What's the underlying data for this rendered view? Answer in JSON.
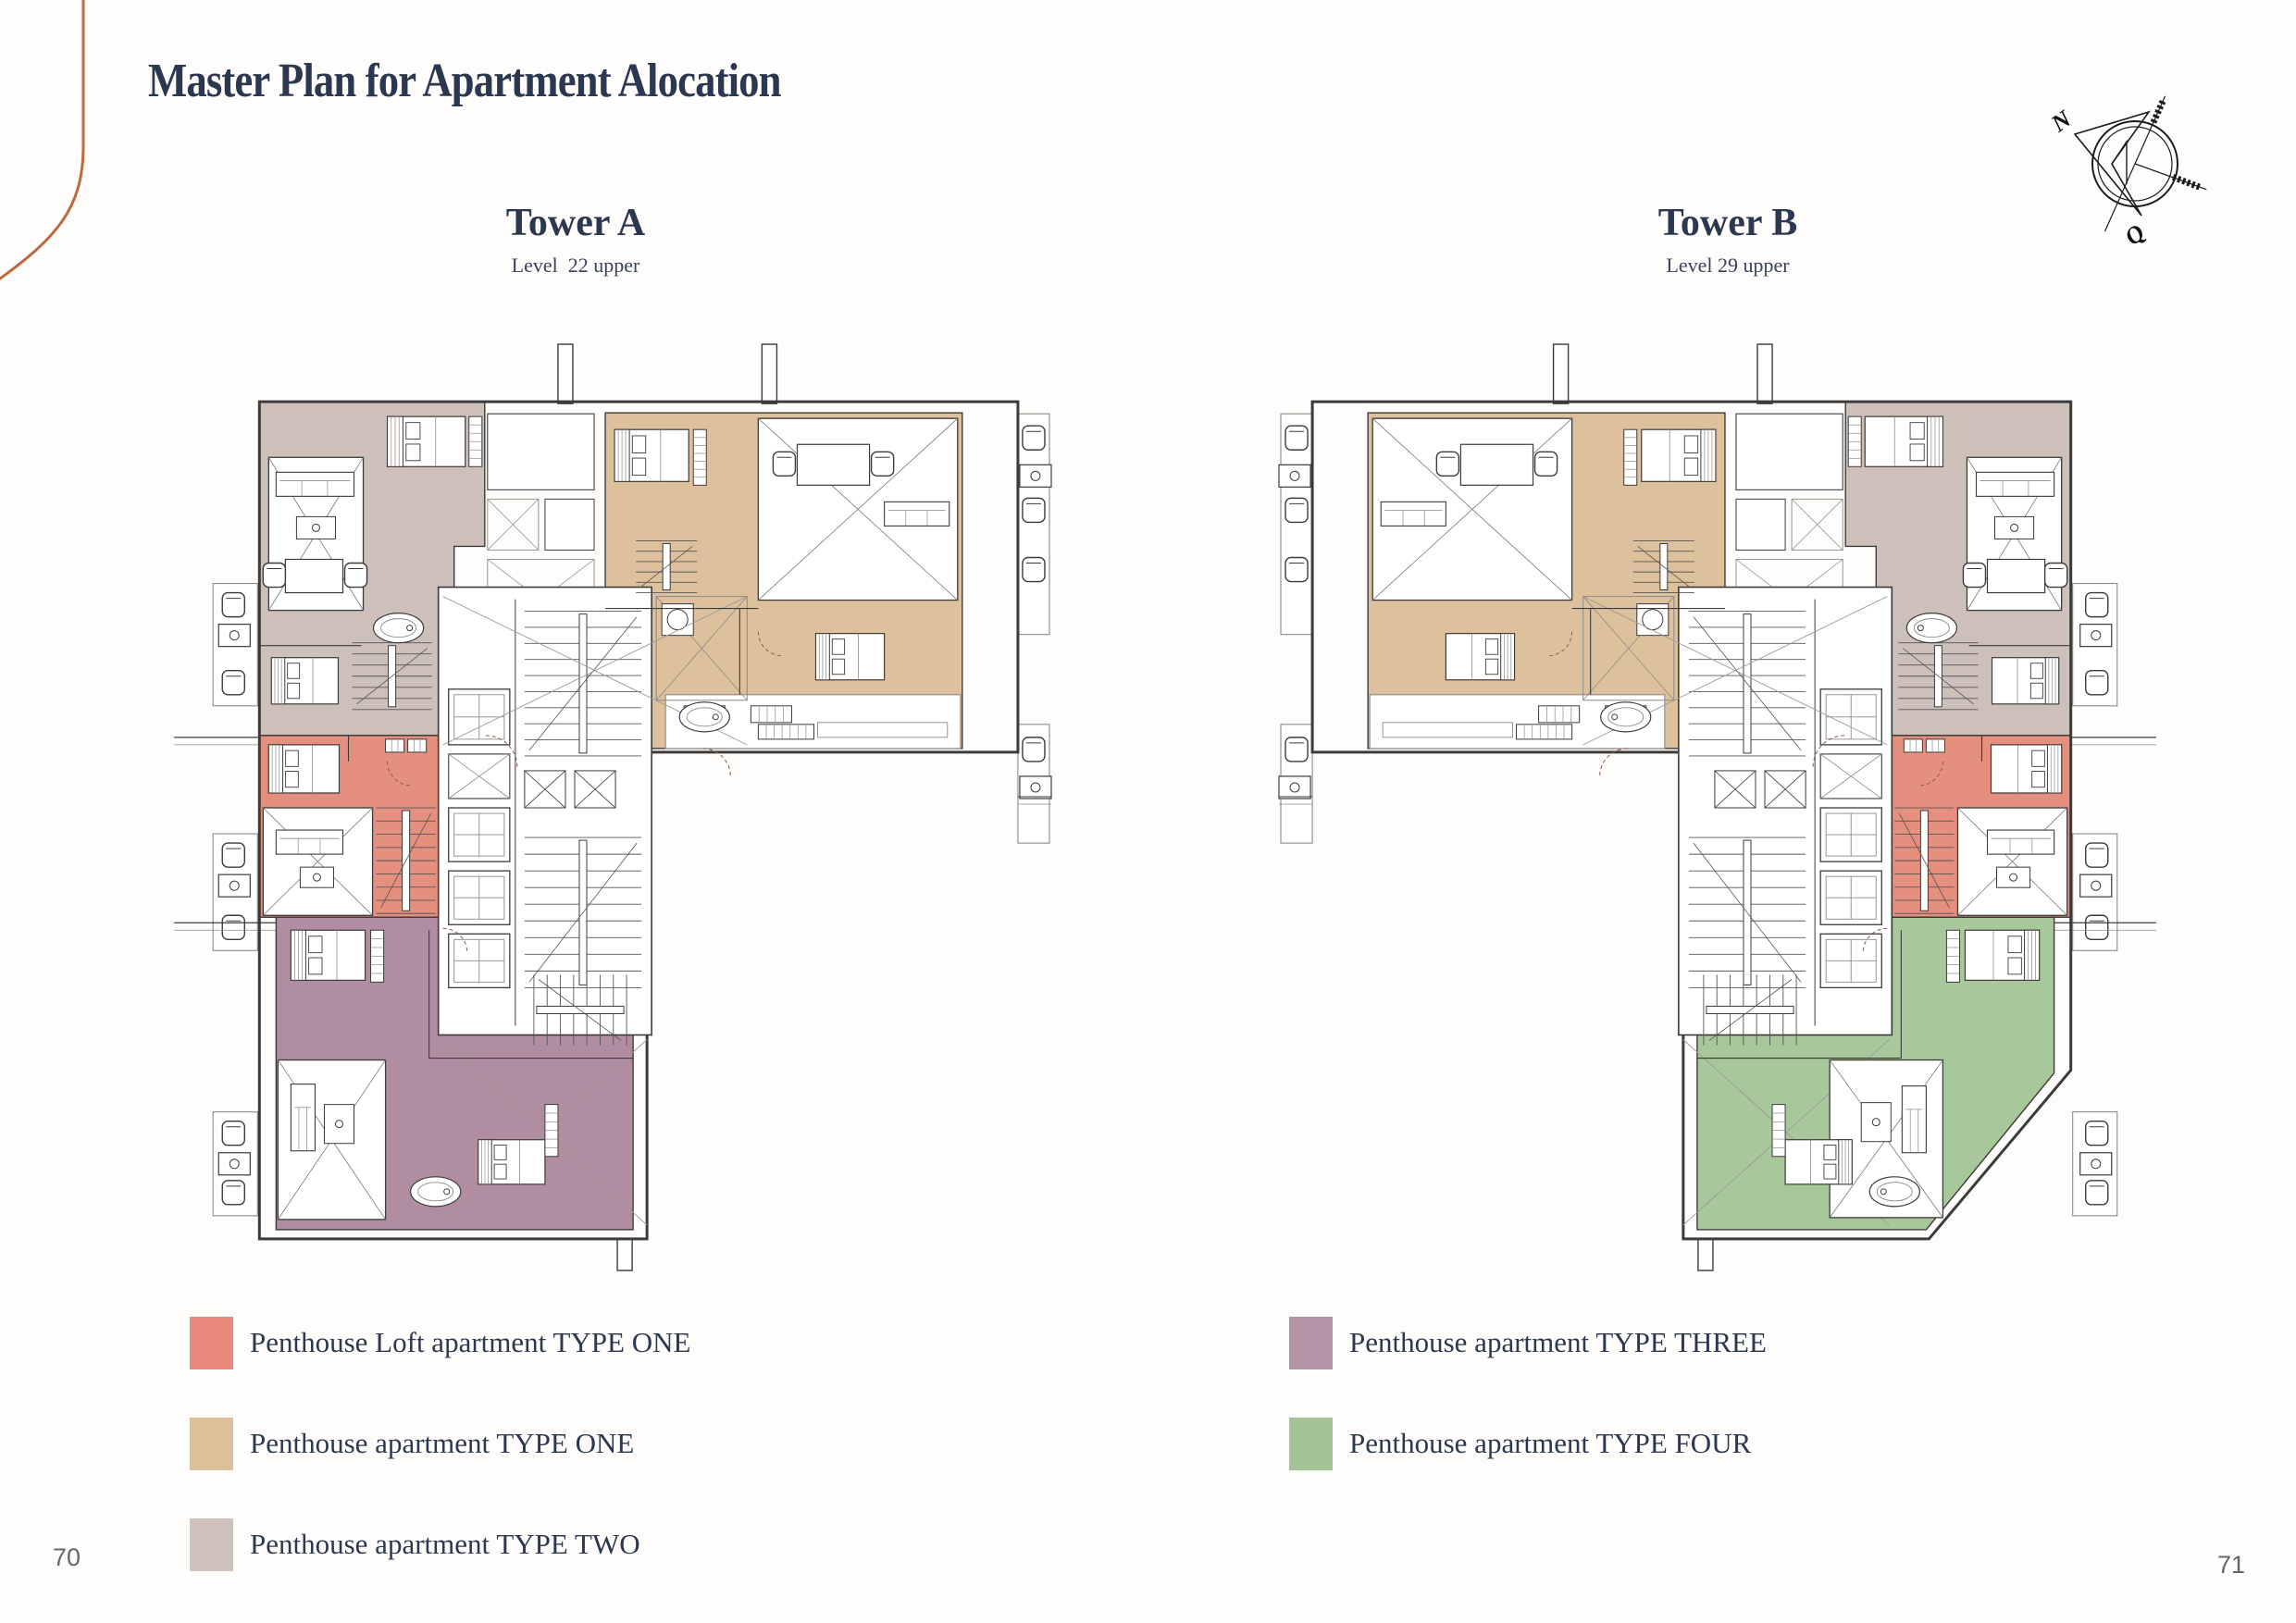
{
  "page": {
    "title": "Master Plan for Apartment Alocation",
    "page_number_left": "70",
    "page_number_right": "71",
    "accent_curve_color": "#bd6a41",
    "background_color": "#fefdfb",
    "heading_color": "#2c3850"
  },
  "towers": [
    {
      "name": "Tower A",
      "level": "Level  22 upper"
    },
    {
      "name": "Tower B",
      "level": "Level 29 upper"
    }
  ],
  "compass": {
    "north_label": "N",
    "quadrant_label": "Q"
  },
  "legend": {
    "left": [
      {
        "label": "Penthouse Loft apartment TYPE ONE",
        "color": "#e8897b"
      },
      {
        "label": "Penthouse apartment TYPE ONE",
        "color": "#dcc09a"
      },
      {
        "label": "Penthouse apartment TYPE TWO",
        "color": "#cfc1bc"
      }
    ],
    "right": [
      {
        "label": "Penthouse apartment TYPE THREE",
        "color": "#b392a5"
      },
      {
        "label": "Penthouse apartment TYPE FOUR",
        "color": "#a4c496"
      }
    ]
  },
  "plan_colors": {
    "loft_type_one": "#e58f7e",
    "type_one": "#ddc19c",
    "type_two": "#cdc0bb",
    "type_three": "#b08da1",
    "type_four": "#a8c79a",
    "wall": "#3d3b39",
    "thin": "#8d8a86"
  }
}
